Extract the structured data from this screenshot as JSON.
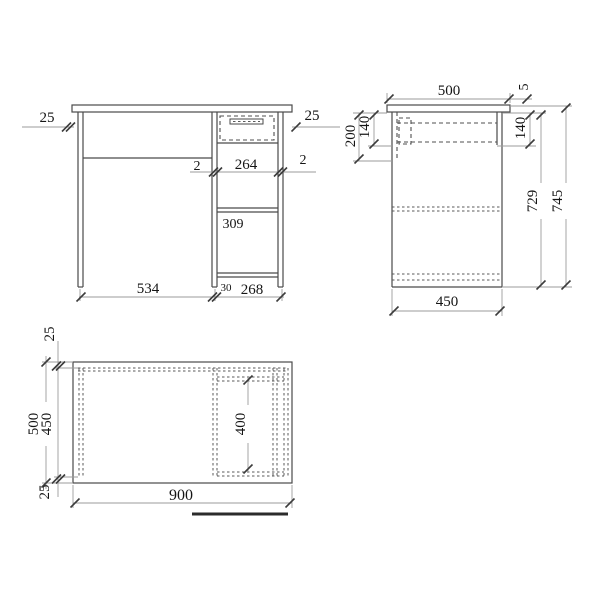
{
  "drawing": {
    "description": "dimensioned furniture drawing of a desk, three orthographic views",
    "front_view": {
      "dims": {
        "top_overhang_left": "25",
        "top_overhang_right": "25",
        "drawer_gap_left": "2",
        "drawer_front_width": "264",
        "drawer_gap_right": "2",
        "shelf_opening_width": "309",
        "kneehole_width": "534",
        "side_thickness": "30",
        "cabinet_outer_width": "268"
      }
    },
    "side_view": {
      "dims": {
        "top_depth": "500",
        "top_overhang": "5",
        "apron_depth": "200",
        "drawer_depth_left": "140",
        "drawer_depth_right": "140",
        "underside_height": "729",
        "overall_height": "745",
        "cabinet_depth": "450"
      }
    },
    "plan_view": {
      "dims": {
        "back_edge_offset": "25",
        "overall_depth": "500",
        "inner_depth": "450",
        "front_edge_offset": "25",
        "overall_width": "900",
        "cabinet_bay_depth": "400"
      }
    },
    "colors": {
      "object_line": "#4a4a4a",
      "hidden_line": "#4f4f4f",
      "dimension_line": "#9b9b9b",
      "text": "#151515",
      "background": "#ffffff"
    }
  }
}
